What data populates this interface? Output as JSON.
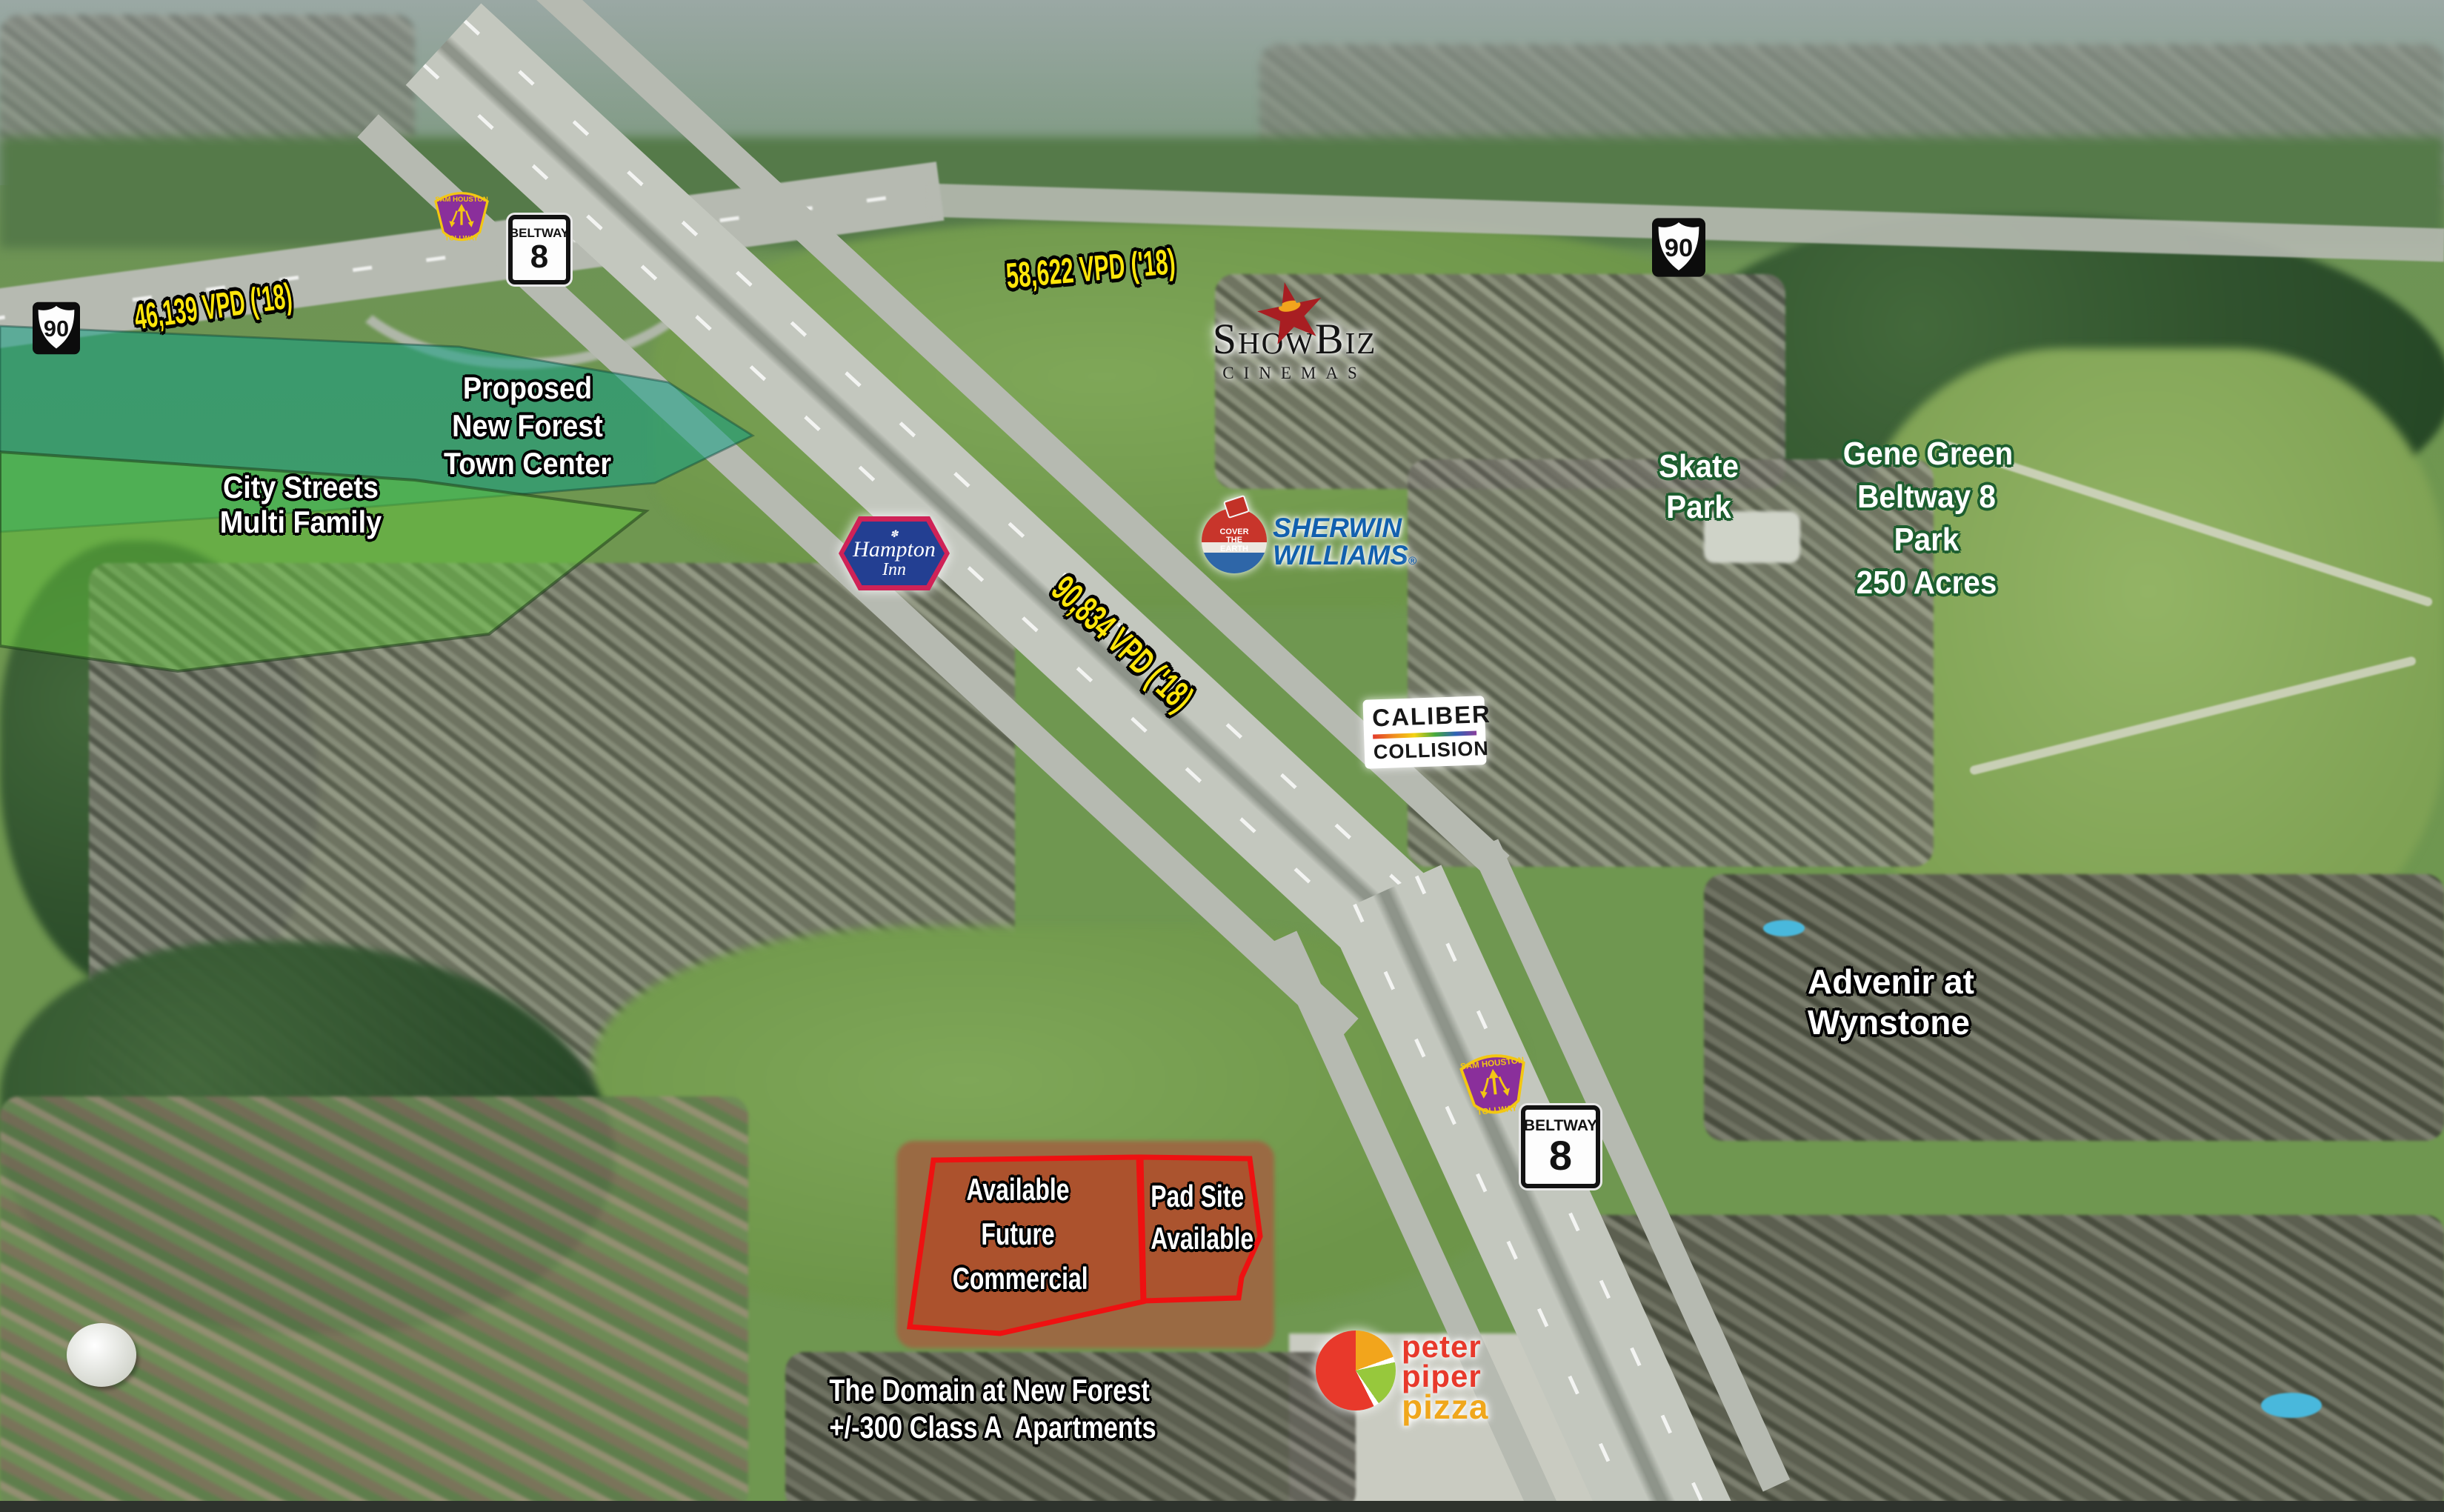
{
  "annotations": {
    "vpd_us90_west": "46,139 VPD ('18)",
    "vpd_us90_east": "58,622 VPD ('18)",
    "vpd_beltway8": "90,834 VPD ('18)",
    "proposed_town_center": {
      "line1": "Proposed",
      "line2": "New Forest",
      "line3": "Town Center"
    },
    "city_streets": {
      "line1": "City Streets",
      "line2": "Multi Family"
    },
    "skate_park": {
      "line1": "Skate",
      "line2": "Park"
    },
    "gene_green_park": {
      "line1": "Gene Green",
      "line2": "Beltway 8",
      "line3": "Park",
      "line4": "250 Acres"
    },
    "advenir": {
      "line1": "Advenir at",
      "line2": "Wynstone"
    },
    "available_commercial": {
      "line1": "Available",
      "line2": "Future",
      "line3": "Commercial"
    },
    "pad_site": {
      "line1": "Pad Site",
      "line2": "Available"
    },
    "domain": {
      "line1": "The Domain at New Forest",
      "line2": "+/-300 Class A  Apartments"
    }
  },
  "shields": {
    "us90": "90",
    "beltway": {
      "label": "BELTWAY",
      "number": "8"
    },
    "tollway": {
      "top": "SAM HOUSTON",
      "bottom": "TOLLWAY"
    }
  },
  "logos": {
    "showbiz": {
      "name": "ShowBiz",
      "sub": "CINEMAS"
    },
    "hampton_inn": {
      "ornament": "✽",
      "line1": "Hampton",
      "line2": "Inn"
    },
    "sherwin_williams": {
      "line1": "SHERWIN",
      "line2": "WILLIAMS",
      "reg": "®",
      "slogan_1": "COVER",
      "slogan_2": "THE",
      "slogan_3": "EARTH"
    },
    "caliber_collision": {
      "line1": "CALIBER",
      "line2": "COLLISION"
    },
    "peter_piper_pizza": {
      "line1": "peter",
      "line2": "piper",
      "line3": "pizza"
    }
  },
  "colors": {
    "vpd_text": "#ffe60a",
    "site_outline": "#ee1111",
    "site_fill": "rgba(188,62,28,0.55)",
    "teal_overlay": "rgba(18,158,132,0.55)",
    "green_overlay": "rgba(98,196,60,0.5)",
    "tollway_purple": "#8a2f9b",
    "tollway_yellow": "#f3c712",
    "sherwin_blue": "#1260ae",
    "hampton_blue": "#233f92",
    "hampton_red": "#cf2257",
    "park_text_outline": "#1d5e2f"
  }
}
